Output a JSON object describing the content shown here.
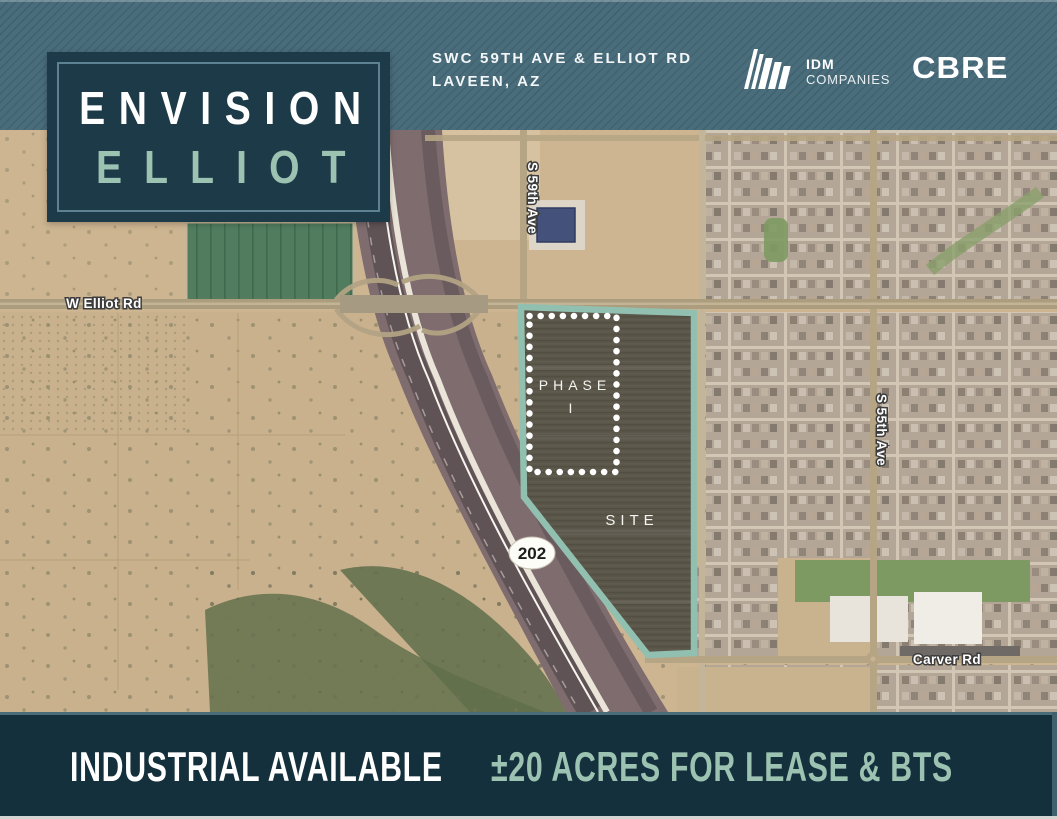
{
  "header": {
    "logo_line1": "ENVISION",
    "logo_line2": "ELLIOT",
    "address_line1": "SWC 59TH AVE & ELLIOT RD",
    "address_line2": "LAVEEN, AZ",
    "idm": {
      "name": "IDM",
      "subname": "COMPANIES"
    },
    "cbre": "CBRE"
  },
  "map": {
    "labels": {
      "elliot": "W Elliot Rd",
      "ave59": "S 59th Ave",
      "ave55": "S 55th Ave",
      "carver": "Carver Rd"
    },
    "site_label": "SITE",
    "phase_label": "PHASE",
    "phase_number": "I",
    "highway_badge": "202"
  },
  "footer": {
    "left": "INDUSTRIAL AVAILABLE",
    "right": "±20 ACRES FOR LEASE & BTS"
  },
  "colors": {
    "header_teal": "#4a6d7c",
    "logo_navy": "#1d3a48",
    "footer_navy": "#15303d",
    "sage": "#9cc2b1",
    "site_outline": "#92c0b0"
  }
}
